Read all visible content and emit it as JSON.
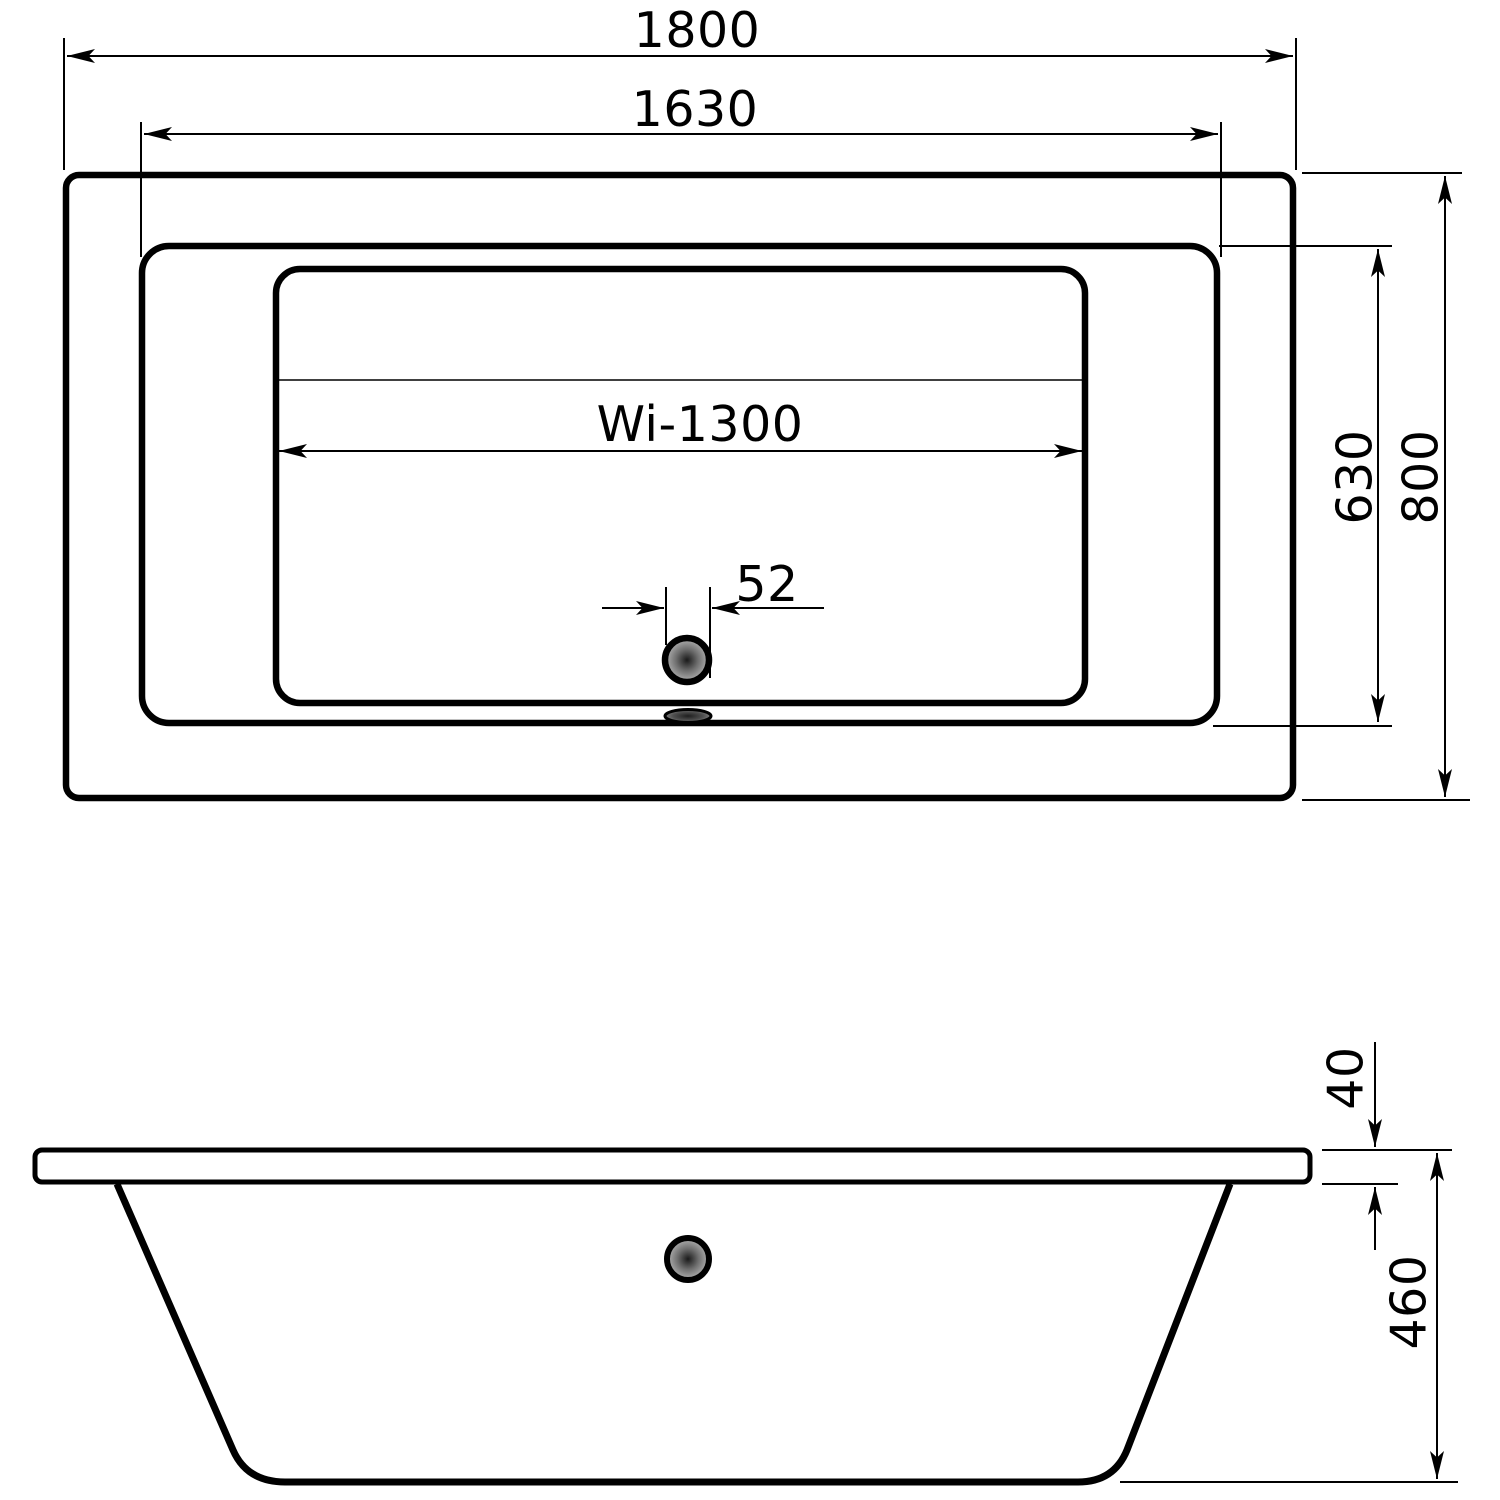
{
  "dims": {
    "overall_length": "1800",
    "rim_length": "1630",
    "inner_width": "Wi-1300",
    "drain_offset": "52",
    "rim_width": "630",
    "overall_width": "800",
    "flange_thickness": "40",
    "total_height": "460"
  },
  "colors": {
    "line": "#000000",
    "background": "#ffffff",
    "drain_center": "#1a1a1a",
    "drain_edge": "#c2c2c2"
  }
}
